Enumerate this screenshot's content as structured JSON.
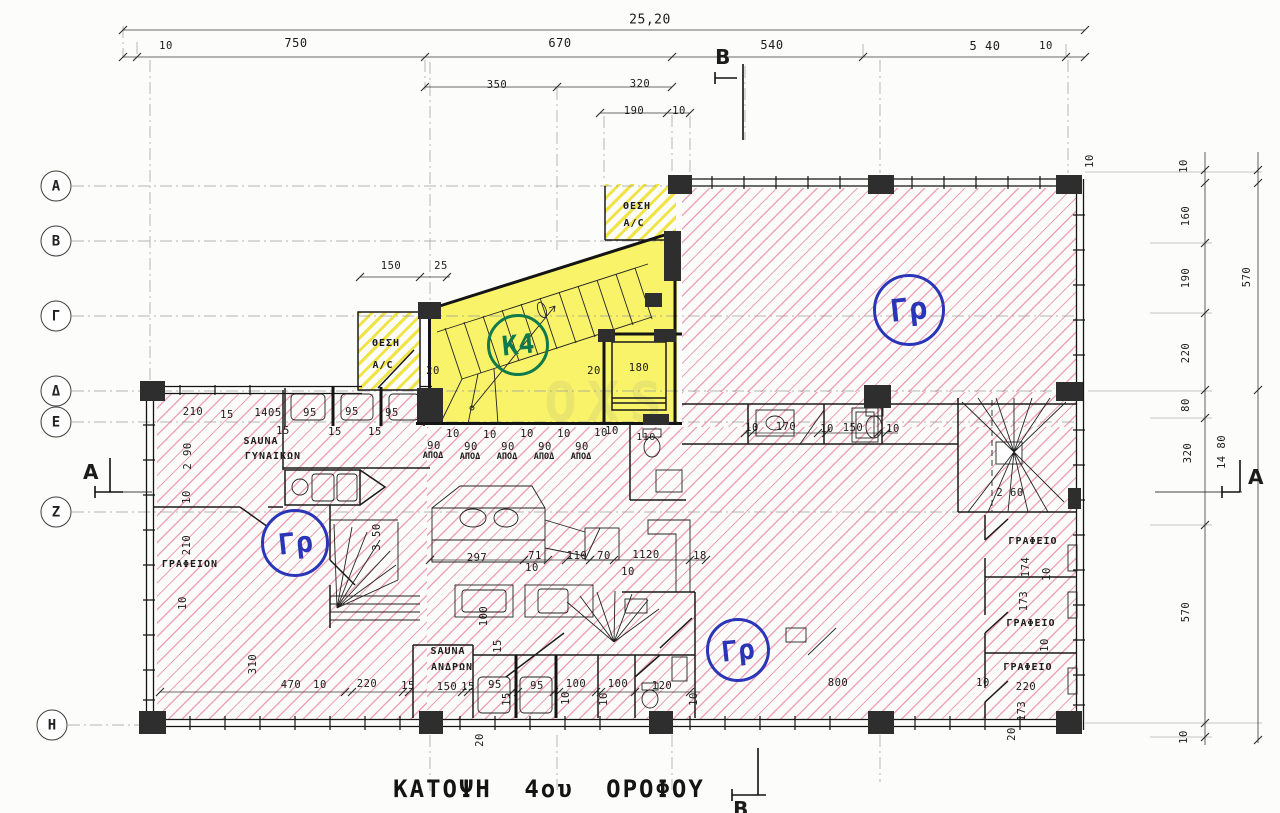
{
  "title": "ΚΑΤΟΨΗ 4ου ΟΡΟΦΟΥ",
  "watermark": "OXS",
  "colors": {
    "hatch_pink": "#e15280",
    "unit_yellow": "#f7f154",
    "circle_blue": "#2a35b8",
    "circle_green": "#117a4c",
    "wall_black": "#141414"
  },
  "grid_axes": {
    "rows": [
      {
        "label": "Α",
        "x": 56,
        "y": 186
      },
      {
        "label": "Β",
        "x": 56,
        "y": 241
      },
      {
        "label": "Γ",
        "x": 56,
        "y": 316
      },
      {
        "label": "Δ",
        "x": 56,
        "y": 391
      },
      {
        "label": "Ε",
        "x": 56,
        "y": 422
      },
      {
        "label": "Ζ",
        "x": 56,
        "y": 512
      },
      {
        "label": "Η",
        "x": 52,
        "y": 725
      }
    ]
  },
  "unit_circles": [
    {
      "label": "Γρ",
      "x": 909,
      "y": 310,
      "r": 33,
      "type": "office"
    },
    {
      "label": "Γρ",
      "x": 295,
      "y": 543,
      "r": 31,
      "type": "office"
    },
    {
      "label": "Γρ",
      "x": 738,
      "y": 650,
      "r": 29,
      "type": "office"
    },
    {
      "label": "Κ4",
      "x": 518,
      "y": 345,
      "r": 28,
      "type": "unit"
    }
  ],
  "labels": [
    {
      "t": "25,20",
      "x": 650,
      "y": 20,
      "s": 13
    },
    {
      "t": "10",
      "x": 166,
      "y": 46
    },
    {
      "t": "750",
      "x": 296,
      "y": 43,
      "s": 12
    },
    {
      "t": "670",
      "x": 560,
      "y": 43,
      "s": 12
    },
    {
      "t": "540",
      "x": 772,
      "y": 45,
      "s": 12
    },
    {
      "t": "5 40",
      "x": 985,
      "y": 46,
      "s": 12
    },
    {
      "t": "10",
      "x": 1046,
      "y": 46
    },
    {
      "t": "350",
      "x": 497,
      "y": 85
    },
    {
      "t": "320",
      "x": 640,
      "y": 84
    },
    {
      "t": "190",
      "x": 634,
      "y": 111
    },
    {
      "t": "10",
      "x": 679,
      "y": 111
    },
    {
      "t": "Β",
      "x": 723,
      "y": 57,
      "cls": "sect"
    },
    {
      "t": "Β",
      "x": 741,
      "y": 809,
      "cls": "sect"
    },
    {
      "t": "Α",
      "x": 91,
      "y": 472,
      "cls": "sect"
    },
    {
      "t": "Α",
      "x": 1256,
      "y": 477,
      "cls": "sect"
    },
    {
      "t": "10",
      "x": 1090,
      "y": 161,
      "r": 1
    },
    {
      "t": "10",
      "x": 1184,
      "y": 166,
      "r": 1
    },
    {
      "t": "160",
      "x": 1186,
      "y": 216,
      "r": 1
    },
    {
      "t": "190",
      "x": 1186,
      "y": 278,
      "r": 1
    },
    {
      "t": "570",
      "x": 1247,
      "y": 277,
      "r": 1
    },
    {
      "t": "220",
      "x": 1186,
      "y": 353,
      "r": 1
    },
    {
      "t": "80",
      "x": 1186,
      "y": 405,
      "r": 1
    },
    {
      "t": "320",
      "x": 1188,
      "y": 453,
      "r": 1
    },
    {
      "t": "14 80",
      "x": 1222,
      "y": 452,
      "r": 1
    },
    {
      "t": "570",
      "x": 1186,
      "y": 612,
      "r": 1
    },
    {
      "t": "10",
      "x": 1184,
      "y": 737,
      "r": 1
    },
    {
      "t": "150",
      "x": 391,
      "y": 266
    },
    {
      "t": "25",
      "x": 441,
      "y": 266
    },
    {
      "t": "ΘΕΣΗ",
      "x": 637,
      "y": 207,
      "cls": "room"
    },
    {
      "t": "A/C",
      "x": 634,
      "y": 224,
      "cls": "room"
    },
    {
      "t": "ΘΕΣΗ",
      "x": 386,
      "y": 344,
      "cls": "room"
    },
    {
      "t": "A/C",
      "x": 383,
      "y": 366,
      "cls": "room"
    },
    {
      "t": "20",
      "x": 433,
      "y": 371
    },
    {
      "t": "20",
      "x": 594,
      "y": 371
    },
    {
      "t": "180",
      "x": 639,
      "y": 368
    },
    {
      "t": "210",
      "x": 193,
      "y": 412
    },
    {
      "t": "15",
      "x": 227,
      "y": 415
    },
    {
      "t": "1405",
      "x": 268,
      "y": 413
    },
    {
      "t": "95",
      "x": 310,
      "y": 413
    },
    {
      "t": "95",
      "x": 352,
      "y": 412
    },
    {
      "t": "95",
      "x": 392,
      "y": 413
    },
    {
      "t": "15",
      "x": 283,
      "y": 431
    },
    {
      "t": "15",
      "x": 335,
      "y": 432
    },
    {
      "t": "15",
      "x": 375,
      "y": 432
    },
    {
      "t": "SAUNA",
      "x": 261,
      "y": 442,
      "cls": "room"
    },
    {
      "t": "ΓΥΝΑΙΚΩΝ",
      "x": 273,
      "y": 457,
      "cls": "room"
    },
    {
      "t": "2 90",
      "x": 188,
      "y": 456,
      "r": 1
    },
    {
      "t": "10",
      "x": 187,
      "y": 497,
      "r": 1
    },
    {
      "t": "210",
      "x": 187,
      "y": 545,
      "r": 1
    },
    {
      "t": "3 50",
      "x": 377,
      "y": 537,
      "r": 1
    },
    {
      "t": "ΓΡΑΦΕΙΟΝ",
      "x": 190,
      "y": 565,
      "cls": "room"
    },
    {
      "t": "10",
      "x": 453,
      "y": 434
    },
    {
      "t": "10",
      "x": 490,
      "y": 435
    },
    {
      "t": "10",
      "x": 527,
      "y": 434
    },
    {
      "t": "10",
      "x": 564,
      "y": 434
    },
    {
      "t": "10",
      "x": 601,
      "y": 433
    },
    {
      "t": "90",
      "x": 434,
      "y": 446
    },
    {
      "t": "90",
      "x": 471,
      "y": 447
    },
    {
      "t": "90",
      "x": 508,
      "y": 447
    },
    {
      "t": "90",
      "x": 545,
      "y": 447
    },
    {
      "t": "90",
      "x": 582,
      "y": 447
    },
    {
      "t": "ΑΠΟΔ",
      "x": 433,
      "y": 456,
      "cls": "tiny"
    },
    {
      "t": "ΑΠΟΔ",
      "x": 470,
      "y": 457,
      "cls": "tiny"
    },
    {
      "t": "ΑΠΟΔ",
      "x": 507,
      "y": 457,
      "cls": "tiny"
    },
    {
      "t": "ΑΠΟΔ",
      "x": 544,
      "y": 457,
      "cls": "tiny"
    },
    {
      "t": "ΑΠΟΔ",
      "x": 581,
      "y": 457,
      "cls": "tiny"
    },
    {
      "t": "10",
      "x": 612,
      "y": 431
    },
    {
      "t": "110",
      "x": 646,
      "y": 438,
      "s": 10
    },
    {
      "t": "297",
      "x": 477,
      "y": 558
    },
    {
      "t": "71",
      "x": 535,
      "y": 556
    },
    {
      "t": "10",
      "x": 532,
      "y": 568
    },
    {
      "t": "110",
      "x": 577,
      "y": 556
    },
    {
      "t": "70",
      "x": 604,
      "y": 556
    },
    {
      "t": "1120",
      "x": 646,
      "y": 555
    },
    {
      "t": "10",
      "x": 628,
      "y": 572
    },
    {
      "t": "18",
      "x": 700,
      "y": 556
    },
    {
      "t": "10",
      "x": 752,
      "y": 428
    },
    {
      "t": "170",
      "x": 786,
      "y": 427
    },
    {
      "t": "10",
      "x": 827,
      "y": 429
    },
    {
      "t": "150",
      "x": 853,
      "y": 428
    },
    {
      "t": "10",
      "x": 893,
      "y": 429
    },
    {
      "t": "2 60",
      "x": 1010,
      "y": 493
    },
    {
      "t": "ΓΡΑΦΕΙΟ",
      "x": 1033,
      "y": 542,
      "cls": "room"
    },
    {
      "t": "174",
      "x": 1026,
      "y": 567,
      "r": 1
    },
    {
      "t": "10",
      "x": 1047,
      "y": 574,
      "r": 1
    },
    {
      "t": "173",
      "x": 1024,
      "y": 601,
      "r": 1
    },
    {
      "t": "ΓΡΑΦΕΙΟ",
      "x": 1031,
      "y": 624,
      "cls": "room"
    },
    {
      "t": "10",
      "x": 1045,
      "y": 645,
      "r": 1
    },
    {
      "t": "ΓΡΑΦΕΙΟ",
      "x": 1028,
      "y": 668,
      "cls": "room"
    },
    {
      "t": "10",
      "x": 983,
      "y": 683
    },
    {
      "t": "220",
      "x": 1026,
      "y": 687
    },
    {
      "t": "173",
      "x": 1022,
      "y": 711,
      "r": 1
    },
    {
      "t": "20",
      "x": 1012,
      "y": 734,
      "r": 1
    },
    {
      "t": "SAUNA",
      "x": 448,
      "y": 652,
      "cls": "room"
    },
    {
      "t": "ΑΝΔΡΩΝ",
      "x": 452,
      "y": 668,
      "cls": "room"
    },
    {
      "t": "100",
      "x": 484,
      "y": 616,
      "r": 1
    },
    {
      "t": "15",
      "x": 498,
      "y": 646,
      "r": 1
    },
    {
      "t": "15",
      "x": 408,
      "y": 686
    },
    {
      "t": "150",
      "x": 447,
      "y": 687
    },
    {
      "t": "15",
      "x": 468,
      "y": 687
    },
    {
      "t": "95",
      "x": 495,
      "y": 685
    },
    {
      "t": "15",
      "x": 507,
      "y": 699,
      "r": 1
    },
    {
      "t": "95",
      "x": 537,
      "y": 686
    },
    {
      "t": "10",
      "x": 566,
      "y": 698,
      "r": 1
    },
    {
      "t": "100",
      "x": 576,
      "y": 684
    },
    {
      "t": "10",
      "x": 604,
      "y": 699,
      "r": 1
    },
    {
      "t": "100",
      "x": 618,
      "y": 684
    },
    {
      "t": "120",
      "x": 662,
      "y": 686
    },
    {
      "t": "10",
      "x": 694,
      "y": 699,
      "r": 1
    },
    {
      "t": "20",
      "x": 480,
      "y": 740,
      "r": 1
    },
    {
      "t": "10",
      "x": 183,
      "y": 603,
      "r": 1
    },
    {
      "t": "310",
      "x": 253,
      "y": 664,
      "r": 1
    },
    {
      "t": "470",
      "x": 291,
      "y": 685
    },
    {
      "t": "10",
      "x": 320,
      "y": 685
    },
    {
      "t": "220",
      "x": 367,
      "y": 684
    },
    {
      "t": "800",
      "x": 838,
      "y": 683
    }
  ]
}
